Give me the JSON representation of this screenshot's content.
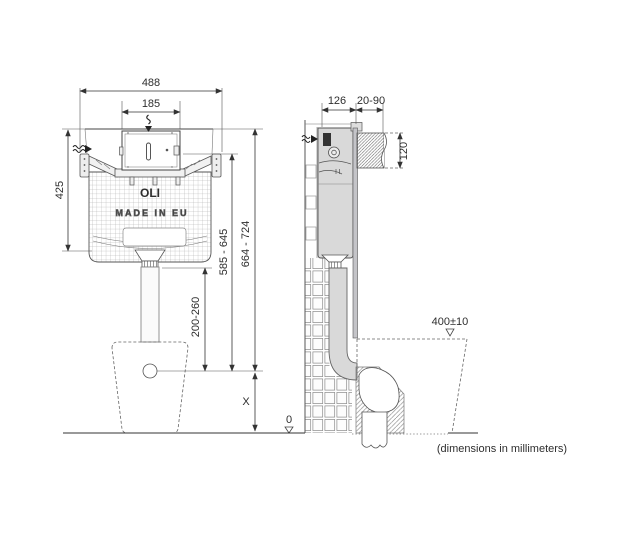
{
  "drawing": {
    "note": "(dimensions in millimeters)",
    "front_view": {
      "overall_width": "488",
      "panel_width": "185",
      "frame_height": "425",
      "panel_height_range": "585 - 645",
      "top_height_range": "664 - 724",
      "flush_pipe_height_range": "200-260",
      "outlet_height": "X",
      "floor_level": "0",
      "brand": "OLI",
      "origin": "MADE IN EU"
    },
    "side_view": {
      "depth": "126",
      "wall_finish_range": "20-90",
      "opening_height": "120",
      "bowl_height": "400±10"
    },
    "icons": {
      "water_flow_arrow": "〰→",
      "datum_triangle": "▽"
    },
    "colors": {
      "line": "#3a3a3a",
      "cistern_fill": "#d9d9d9",
      "hatch": "#666666",
      "background": "#ffffff"
    }
  }
}
